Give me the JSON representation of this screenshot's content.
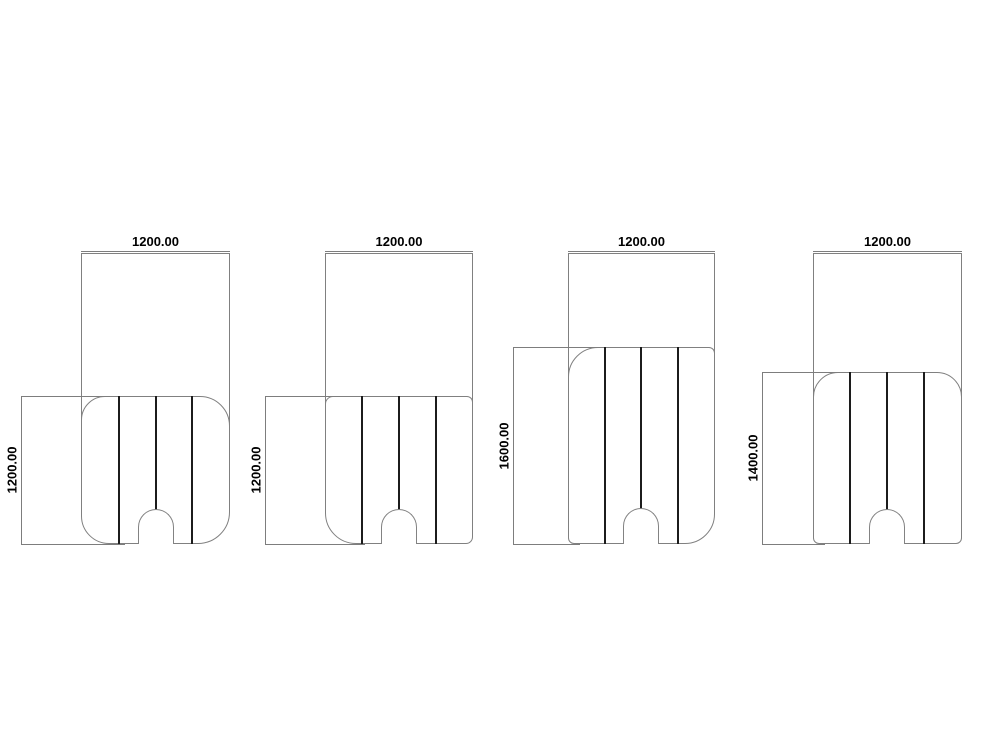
{
  "drawing": {
    "type": "technical-drawing",
    "background": "#ffffff",
    "outline_color": "#808080",
    "seam_color": "#1c1c1c",
    "text_color": "#000000",
    "figures": [
      {
        "name": "panel-a",
        "width_dim_label": "1200.00",
        "height_dim_label": "1200.00",
        "back": {
          "x": 81,
          "y": 253,
          "w": 149,
          "h": 259
        },
        "seat": {
          "x": 81,
          "y": 396,
          "w": 149,
          "h": 148,
          "radius": [
            24,
            30,
            32,
            28
          ]
        },
        "divider_xs": [
          119,
          156,
          192
        ],
        "arch_cx": 156,
        "arch_top": 509,
        "top_dim": {
          "y": 251,
          "x1": 81,
          "x2": 230
        },
        "side_dim": {
          "x": 21,
          "y1": 396,
          "y2": 544,
          "ext_top": [
            21,
            110
          ],
          "ext_bot": [
            21,
            125
          ]
        }
      },
      {
        "name": "panel-b",
        "width_dim_label": "1200.00",
        "height_dim_label": "1200.00",
        "back": {
          "x": 325,
          "y": 253,
          "w": 148,
          "h": 260
        },
        "seat": {
          "x": 325,
          "y": 396,
          "w": 148,
          "h": 148,
          "radius": [
            8,
            6,
            7,
            31
          ]
        },
        "divider_xs": [
          362,
          399,
          436
        ],
        "arch_cx": 399,
        "arch_top": 509,
        "top_dim": {
          "y": 251,
          "x1": 325,
          "x2": 473
        },
        "side_dim": {
          "x": 265,
          "y1": 396,
          "y2": 544,
          "ext_top": [
            265,
            340
          ],
          "ext_bot": [
            265,
            365
          ]
        }
      },
      {
        "name": "panel-c",
        "width_dim_label": "1200.00",
        "height_dim_label": "1600.00",
        "back": {
          "x": 568,
          "y": 253,
          "w": 147,
          "h": 261
        },
        "seat": {
          "x": 568,
          "y": 347,
          "w": 147,
          "h": 197,
          "radius": [
            30,
            6,
            30,
            6
          ]
        },
        "divider_xs": [
          605,
          641,
          678
        ],
        "arch_cx": 641,
        "arch_top": 508,
        "top_dim": {
          "y": 251,
          "x1": 568,
          "x2": 715
        },
        "side_dim": {
          "x": 513,
          "y1": 347,
          "y2": 544,
          "ext_top": [
            513,
            600
          ],
          "ext_bot": [
            513,
            580
          ]
        }
      },
      {
        "name": "panel-d",
        "width_dim_label": "1200.00",
        "height_dim_label": "1400.00",
        "back": {
          "x": 813,
          "y": 253,
          "w": 149,
          "h": 285
        },
        "seat": {
          "x": 813,
          "y": 372,
          "w": 149,
          "h": 172,
          "radius": [
            25,
            25,
            6,
            6
          ]
        },
        "divider_xs": [
          850,
          887,
          924
        ],
        "arch_cx": 887,
        "arch_top": 509,
        "top_dim": {
          "y": 251,
          "x1": 813,
          "x2": 962
        },
        "side_dim": {
          "x": 762,
          "y1": 372,
          "y2": 544,
          "ext_top": [
            762,
            840
          ],
          "ext_bot": [
            762,
            825
          ]
        }
      }
    ]
  }
}
